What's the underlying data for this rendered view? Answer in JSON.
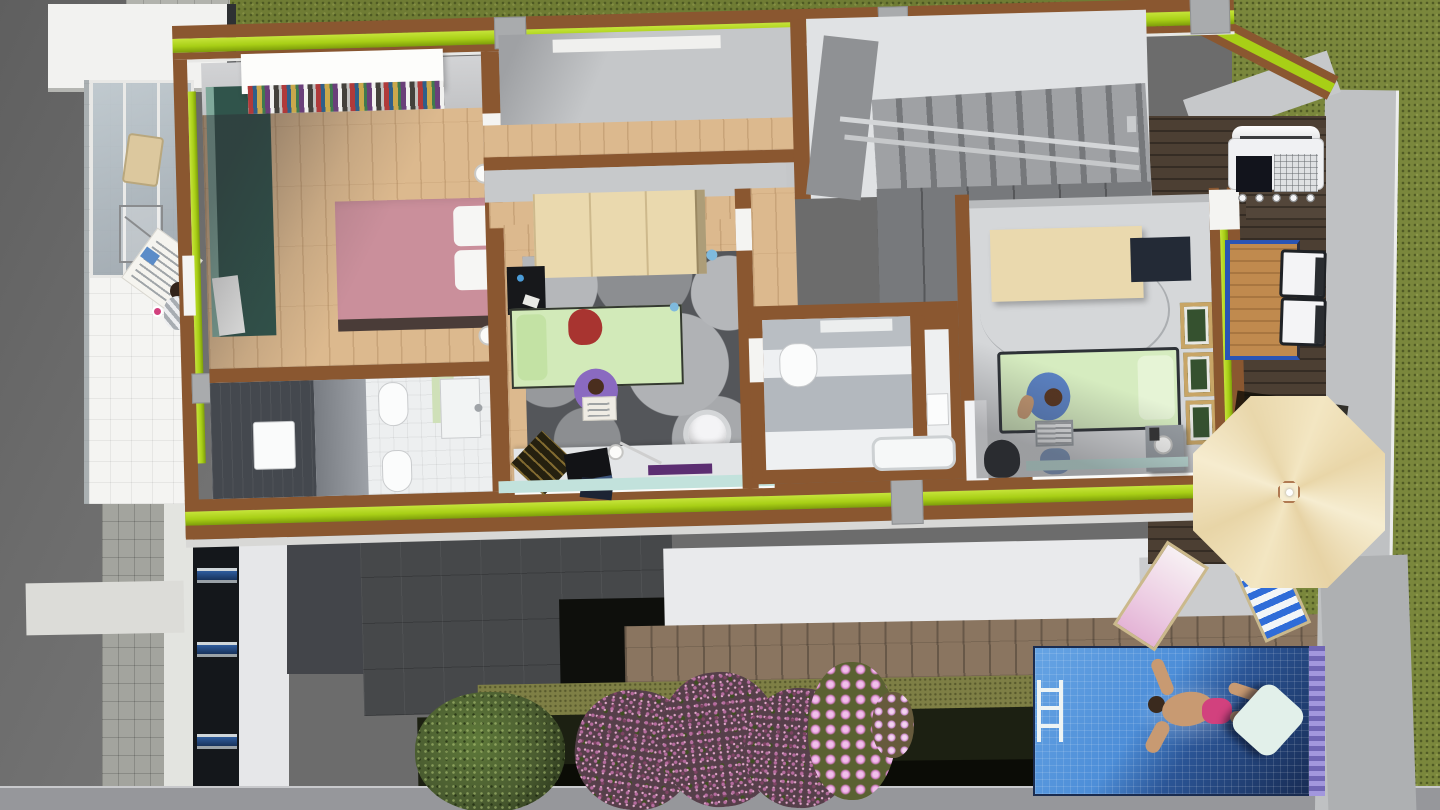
{
  "title": "3d-floor-plan-render",
  "palette": {
    "asphalt": "#6c6c6c",
    "pavement": "#b2b3ad",
    "grass": "#6f7c34",
    "grass_bright": "#7a873c",
    "concrete_wall": "#bfc1c3",
    "white_surface": "#f0f0ee",
    "roof_slab": "#46484a",
    "shadow_black": "#0e0f0c",
    "deck_outdoor": "#8a7560",
    "deck_terrace": "#4c3f33",
    "wall_brown": "#8a5730",
    "trim_lime": "#a8cf16",
    "floor_wood": "#dcb98e",
    "wood_light": "#ead9ae",
    "floor_gray": "#d5d7d9",
    "rug_gray": "#54565a",
    "wardrobe_teal": "#30544b",
    "bed_pink": "#ca8f9b",
    "bed_green": "#d2eab9",
    "shelf_teal": "#c2e2dc",
    "bath_tile_dark": "#44484e",
    "accent_green_wall": "#cfe0b8",
    "pool_light": "#4d8ed8",
    "pool_dark": "#16284e",
    "pool_tile": "#8379c8",
    "umbrella_tan": "#f2e4bf",
    "flower_purple": "#b76da0",
    "flower_pink": "#d985cc",
    "bush_green": "#4f6230",
    "table_blue": "#2a54b4",
    "swim_skin": "#c89a72",
    "swim_trunks": "#d2417e",
    "denim": "#5b82c4"
  },
  "scene": {
    "type": "architectural-3d-top-view",
    "floor": "upper floor cutaway",
    "rooms": [
      {
        "name": "master-bedroom",
        "floor": "wood",
        "furniture": [
          "double-bed-pink",
          "two-pillows",
          "bookshelf-colored-books",
          "teal-wardrobe",
          "two-round-lamps"
        ]
      },
      {
        "name": "bathroom-left",
        "floor": "white-and-dark-tile",
        "fixtures": [
          "washbasin",
          "bidet",
          "toilet",
          "shower",
          "green-accent-wall"
        ]
      },
      {
        "name": "kids-room",
        "floor": "wood",
        "furniture": [
          "green-single-bed",
          "red-blanket",
          "circle-pattern-rug",
          "loft-canopy",
          "black-desk",
          "white-tub-chair",
          "study-desk-laptop",
          "teal-shelf"
        ],
        "people": [
          "child-reading-on-purple-pouf"
        ]
      },
      {
        "name": "bathroom-middle",
        "floor": "white-tile",
        "fixtures": [
          "toilet",
          "bathtub",
          "sink-niche"
        ]
      },
      {
        "name": "stair-hall",
        "features": [
          "gray-staircase",
          "metal-railing",
          "dark-closet-wall"
        ]
      },
      {
        "name": "teen-bedroom",
        "floor": "gray",
        "furniture": [
          "green-single-bed",
          "tan-wardrobe-top",
          "three-picture-frames",
          "nightstand-lamp",
          "desk-sink",
          "black-chair",
          "teal-shelf"
        ],
        "people": [
          "teen-with-laptop"
        ]
      }
    ],
    "outdoor": [
      {
        "name": "balcony-west",
        "features": [
          "glass-canopy",
          "cafe-chair",
          "wire-table"
        ],
        "people": [
          "person-reading-newspaper-striped-shirt-pink-mug"
        ]
      },
      {
        "name": "terrace-east",
        "features": [
          "bbq-grill",
          "wood-table-blue-trim",
          "two-white-chairs",
          "dark-wood-deck",
          "octagonal-tan-parasol"
        ]
      },
      {
        "name": "garden-south",
        "features": [
          "green-bush",
          "purple-flower-bushes",
          "pink-daisies",
          "moss-strip",
          "light-wood-deck"
        ]
      },
      {
        "name": "pool",
        "features": [
          "blue-mosaic-water",
          "ladder",
          "white-float"
        ],
        "people": [
          "swimmer-pink-trunks"
        ]
      },
      {
        "name": "sun-deck",
        "features": [
          "pink-lounger",
          "blue-striped-lounger"
        ]
      }
    ],
    "environment": [
      "gray-asphalt-west",
      "tiled-sidewalk",
      "grass-field-east",
      "ground-floor-dark-roof",
      "white-roof-band",
      "facade-windows-strip"
    ],
    "wall_style": "brown cut walls with lime-green trim band",
    "people_count": 4,
    "picture_frames_count": 3,
    "terrace_chairs_count": 2,
    "loungers_count": 2
  }
}
